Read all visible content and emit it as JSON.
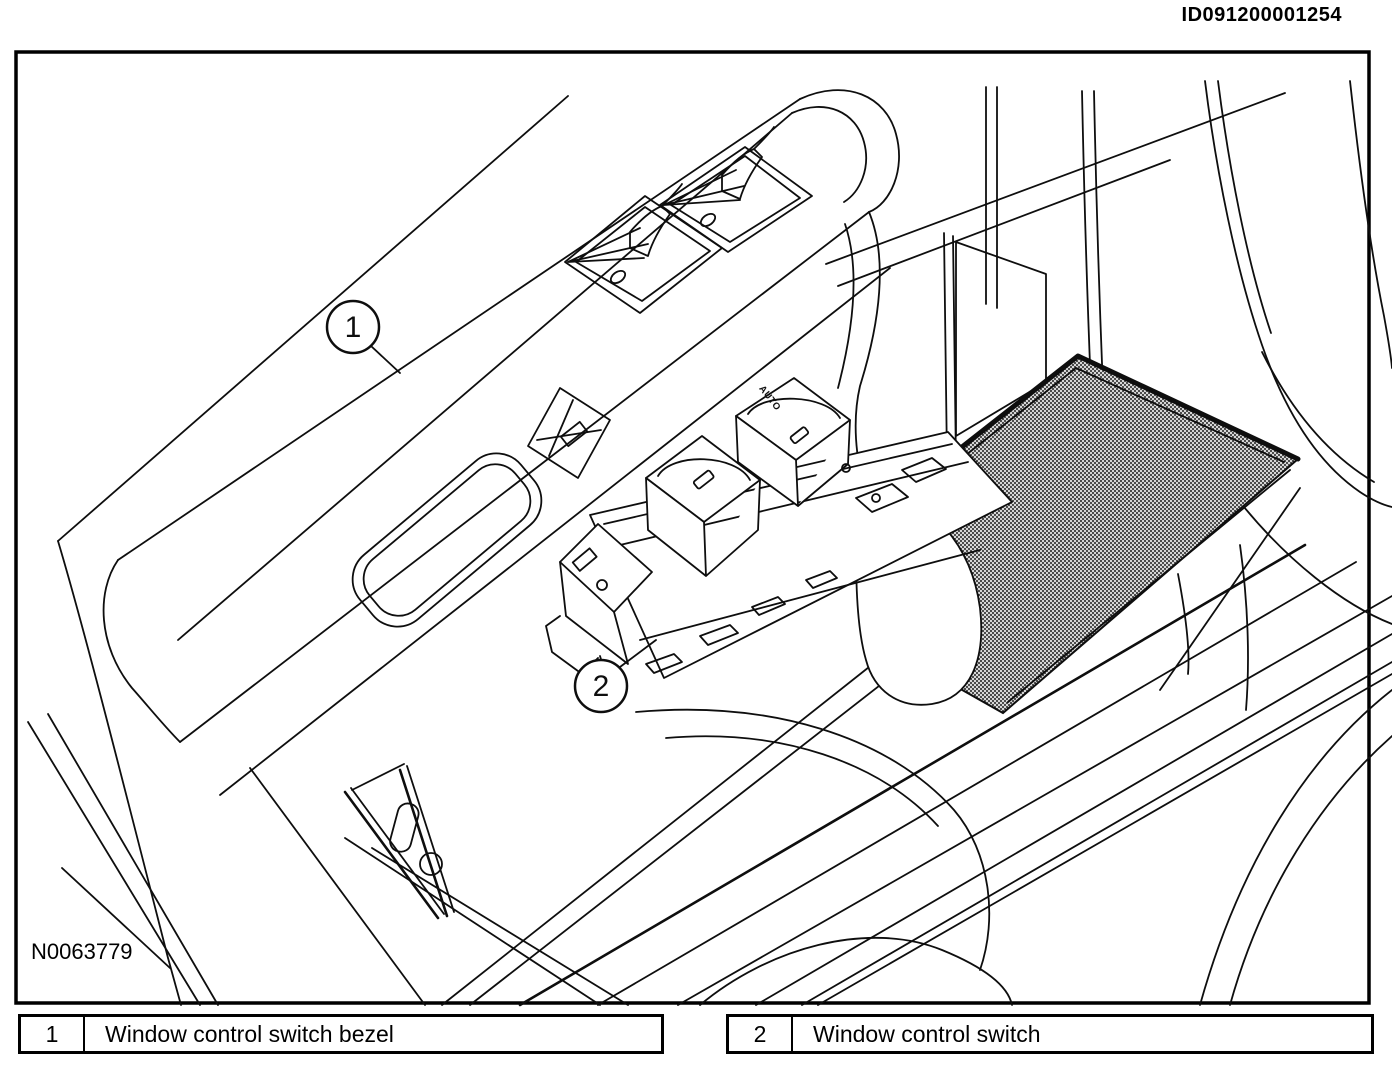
{
  "page": {
    "id_code": "ID091200001254",
    "figure_code": "N0063779"
  },
  "callouts": [
    {
      "number": "1"
    },
    {
      "number": "2"
    }
  ],
  "legend": {
    "rows": [
      {
        "num": "1",
        "label": "Window control switch bezel"
      },
      {
        "num": "2",
        "label": "Window control switch"
      }
    ]
  },
  "switch_assembly": {
    "marking": "AUTO"
  },
  "colors": {
    "line": "#000000",
    "background": "#ffffff",
    "carpet_fill": "#cfcfcf",
    "carpet_dot": "#141414"
  }
}
